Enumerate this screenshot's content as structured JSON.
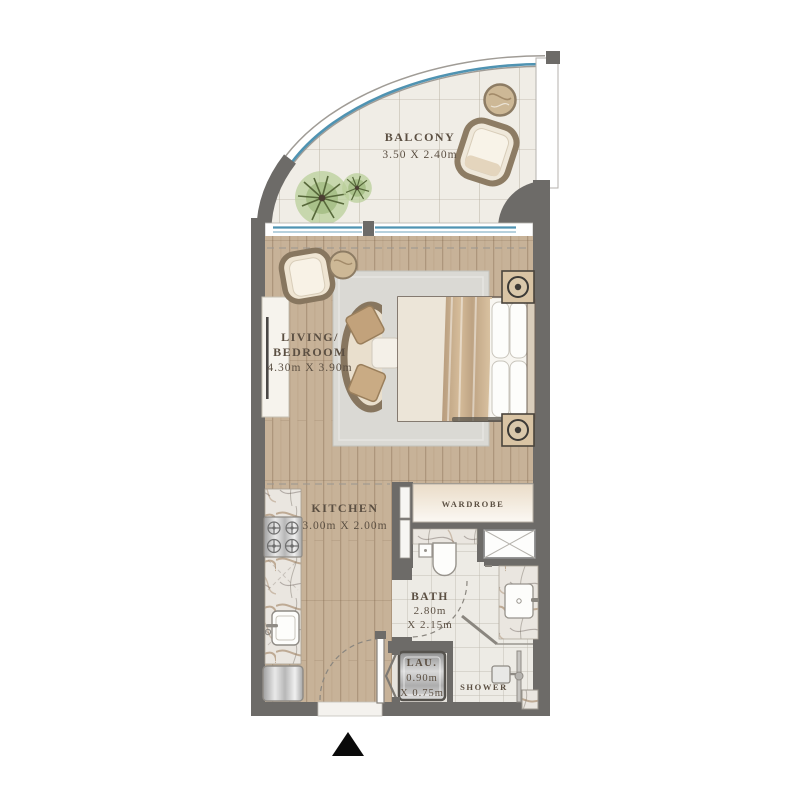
{
  "rooms": {
    "balcony": {
      "name": "BALCONY",
      "dims": "3.50 X 2.40m"
    },
    "living_bedroom": {
      "name_line1": "LIVING/",
      "name_line2": "BEDROOM",
      "dims": "4.30m X 3.90m"
    },
    "kitchen": {
      "name": "KITCHEN",
      "dims": "3.00m X 2.00m"
    },
    "wardrobe": {
      "name": "WARDROBE"
    },
    "bath": {
      "name": "BATH",
      "dims_line1": "2.80m",
      "dims_line2": "X 2.15m"
    },
    "laundry": {
      "name": "LAU.",
      "dims_line1": "0.90m",
      "dims_line2": "X 0.75m"
    },
    "shower": {
      "name": "SHOWER"
    }
  },
  "colors": {
    "wall": "#6d6b68",
    "glass_line": "#4f93b2",
    "wood_floor": "#c7b298",
    "balcony_floor": "#f0ede6",
    "label_text": "#5b4f42",
    "rug": "#dad9d4",
    "entry_marker": "#0a0a0a"
  }
}
